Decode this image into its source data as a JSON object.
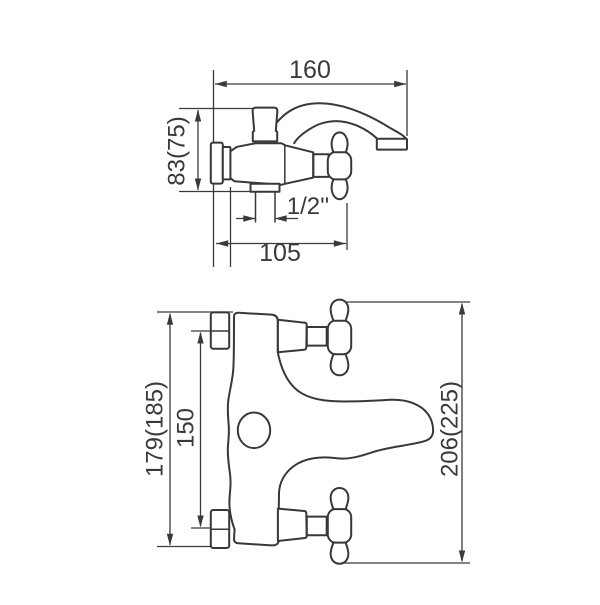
{
  "drawing": {
    "type": "technical-dimension-drawing",
    "subject": "wall-mounted bath mixer faucet, side view and top view",
    "colors": {
      "line": "#3a3a3a",
      "background": "#ffffff"
    }
  },
  "side_view": {
    "width_label": "160",
    "height_label": "83(75)",
    "thread_label": "1/2''",
    "depth_label": "105"
  },
  "top_view": {
    "overall_label": "179(185)",
    "spacing_label": "150",
    "length_label": "206(225)"
  }
}
